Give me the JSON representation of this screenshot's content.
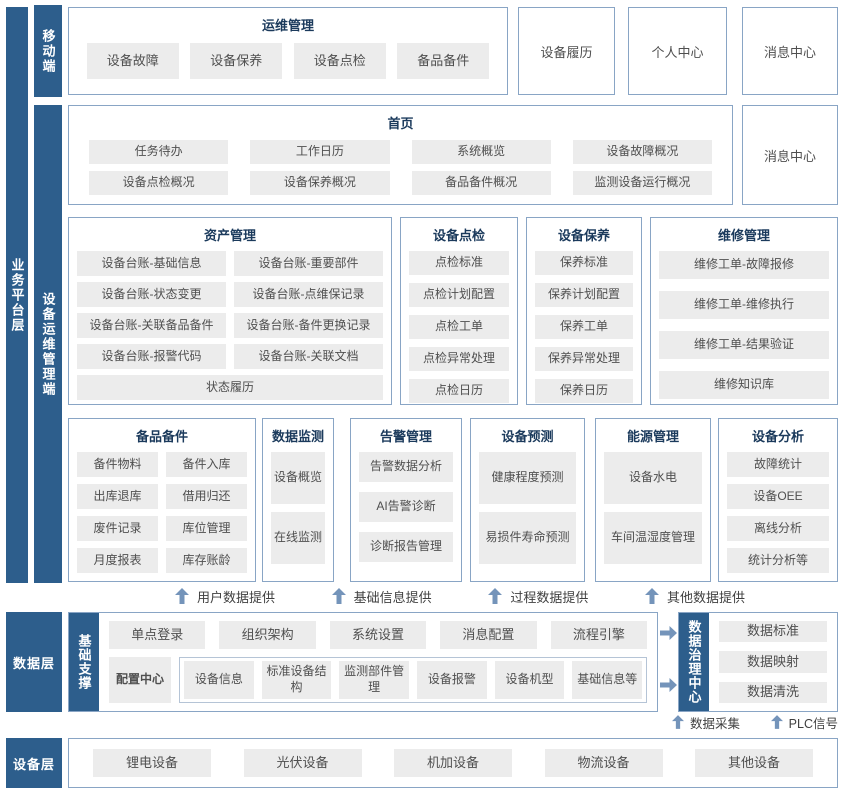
{
  "colors": {
    "rail_dark_blue": "#2d5e8c",
    "box_border_blue": "#89a5c5",
    "item_gray": "#ececec",
    "arrow_steel_blue": "#7494ba",
    "title_navy": "#1b3a5c",
    "item_text_gray": "#4f4f4f"
  },
  "rails": {
    "platform": "业务平台层",
    "mobile": "移动端",
    "ops": "设备运维管理端"
  },
  "mobile_row": {
    "title": "运维管理",
    "items": [
      "设备故障",
      "设备保养",
      "设备点检",
      "备品备件"
    ],
    "boxes": [
      "设备履历",
      "个人中心",
      "消息中心"
    ]
  },
  "home_row": {
    "title": "首页",
    "items": [
      "任务待办",
      "工作日历",
      "系统概览",
      "设备故障概况",
      "设备点检概况",
      "设备保养概况",
      "备品备件概况",
      "监测设备运行概况"
    ],
    "side_box": "消息中心"
  },
  "modules_row1": {
    "asset": {
      "title": "资产管理",
      "items": [
        "设备台账-基础信息",
        "设备台账-重要部件",
        "设备台账-状态变更",
        "设备台账-点维保记录",
        "设备台账-关联备品备件",
        "设备台账-备件更换记录",
        "设备台账-报警代码",
        "设备台账-关联文档"
      ],
      "footer": "状态履历"
    },
    "inspection": {
      "title": "设备点检",
      "items": [
        "点检标准",
        "点检计划配置",
        "点检工单",
        "点检异常处理",
        "点检日历"
      ]
    },
    "maintenance": {
      "title": "设备保养",
      "items": [
        "保养标准",
        "保养计划配置",
        "保养工单",
        "保养异常处理",
        "保养日历"
      ]
    },
    "repair": {
      "title": "维修管理",
      "items": [
        "维修工单-故障报修",
        "维修工单-维修执行",
        "维修工单-结果验证",
        "维修知识库"
      ]
    }
  },
  "modules_row2": {
    "spare": {
      "title": "备品备件",
      "items": [
        "备件物料",
        "备件入库",
        "出库退库",
        "借用归还",
        "废件记录",
        "库位管理",
        "月度报表",
        "库存账龄"
      ]
    },
    "monitor": {
      "title": "数据监测",
      "items": [
        "设备概览",
        "在线监测"
      ]
    },
    "alarm": {
      "title": "告警管理",
      "items": [
        "告警数据分析",
        "AI告警诊断",
        "诊断报告管理"
      ]
    },
    "predict": {
      "title": "设备预测",
      "items": [
        "健康程度预测",
        "易损件寿命预测"
      ]
    },
    "energy": {
      "title": "能源管理",
      "items": [
        "设备水电",
        "车间温湿度管理"
      ]
    },
    "analysis": {
      "title": "设备分析",
      "items": [
        "故障统计",
        "设备OEE",
        "离线分析",
        "统计分析等"
      ]
    }
  },
  "flow_up": [
    "用户数据提供",
    "基础信息提供",
    "过程数据提供",
    "其他数据提供"
  ],
  "data_layer": {
    "rail": "数据层",
    "support_rail": "基础支撑",
    "row1": [
      "单点登录",
      "组织架构",
      "系统设置",
      "消息配置",
      "流程引擎"
    ],
    "config_center": "配置中心",
    "config_items": [
      "设备信息",
      "标准设备结构",
      "监测部件管理",
      "设备报警",
      "设备机型",
      "基础信息等"
    ]
  },
  "governance": {
    "rail": "数据治理中心",
    "items": [
      "数据标准",
      "数据映射",
      "数据清洗"
    ]
  },
  "flow_bottom": [
    "数据采集",
    "PLC信号"
  ],
  "device_layer": {
    "rail": "设备层",
    "items": [
      "锂电设备",
      "光伏设备",
      "机加设备",
      "物流设备",
      "其他设备"
    ]
  }
}
